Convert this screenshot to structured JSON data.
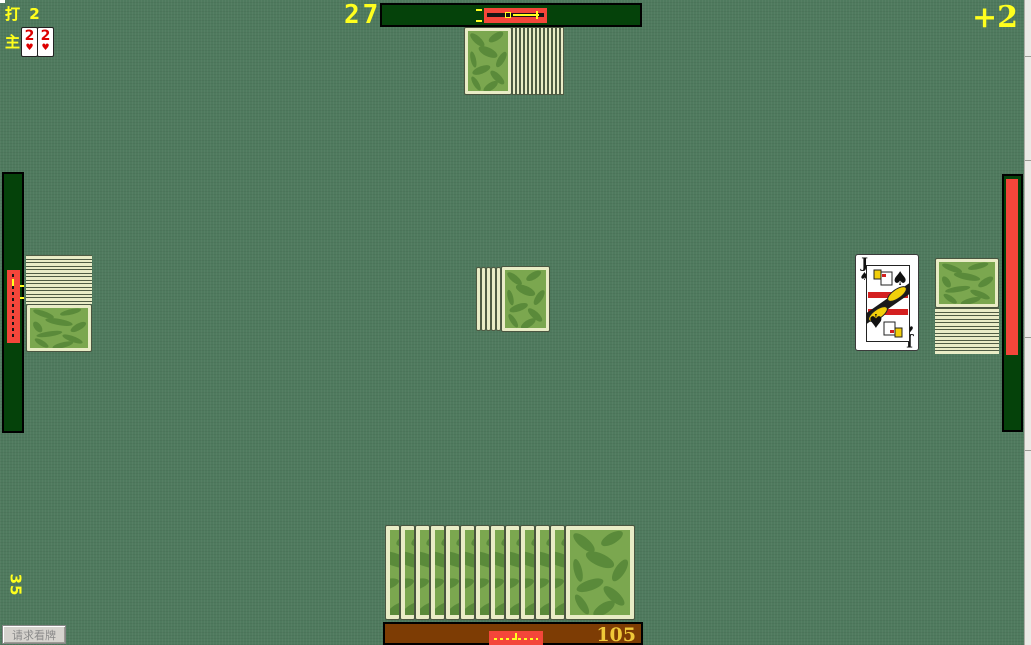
{
  "colors": {
    "felt": "#4f7a5e",
    "panel_green": "#05420a",
    "accent_red": "#f4463a",
    "accent_yellow": "#ffff1e",
    "south_brown": "#7d3c04",
    "card_cream": "#e9ecc6",
    "card_green": "#7ba74f",
    "leaf_green": "#5a8a3a",
    "gold": "#f0c838"
  },
  "top_left": {
    "declare_label": "打 2",
    "trump_label": "主",
    "trump_cards": [
      {
        "rank": "2",
        "suit": "♥"
      },
      {
        "rank": "2",
        "suit": "♥"
      }
    ]
  },
  "north": {
    "counter": "27",
    "bonus": "+2",
    "stack_edge_count": 13
  },
  "center": {
    "stack_edge_count": 5
  },
  "west": {
    "score": "35",
    "stack_edge_count": 14
  },
  "east": {
    "played_card": {
      "rank": "J",
      "suit": "♠"
    },
    "stack_edge_count": 13
  },
  "south": {
    "score": "105",
    "hand_edge_count": 12
  },
  "controls": {
    "view_cards_label": "请求看牌"
  }
}
